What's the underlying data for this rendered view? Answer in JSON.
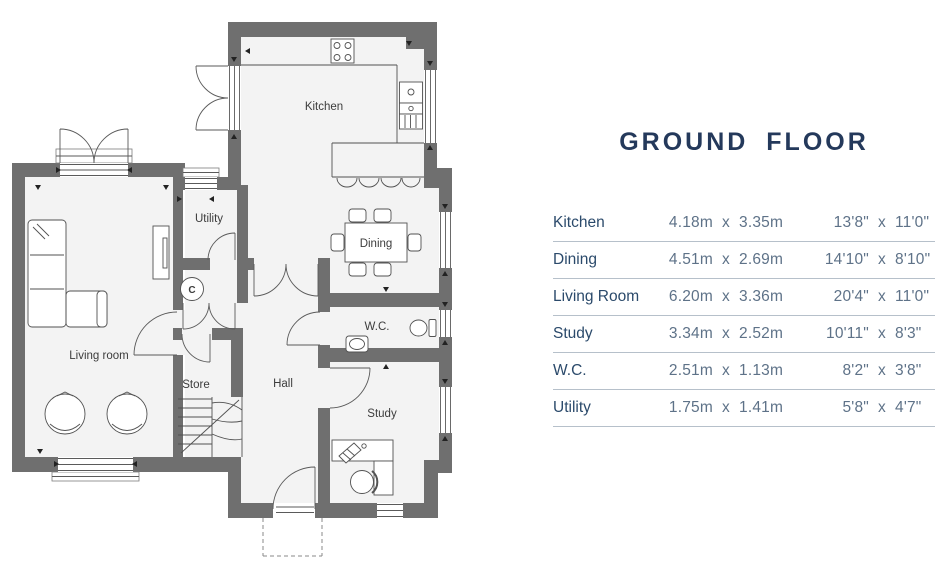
{
  "title": "GROUND FLOOR",
  "plan": {
    "labels": {
      "kitchen": "Kitchen",
      "utility": "Utility",
      "dining": "Dining",
      "living_room": "Living room",
      "wc": "W.C.",
      "store": "Store",
      "hall": "Hall",
      "study": "Study",
      "cylinder": "C"
    }
  },
  "dimensions_table": {
    "separator": "x",
    "rows": [
      {
        "name": "Kitchen",
        "metric_w": "4.18m",
        "metric_d": "3.35m",
        "imperial_w": "13'8\"",
        "imperial_d": "11'0\""
      },
      {
        "name": "Dining",
        "metric_w": "4.51m",
        "metric_d": "2.69m",
        "imperial_w": "14'10\"",
        "imperial_d": "8'10\""
      },
      {
        "name": "Living Room",
        "metric_w": "6.20m",
        "metric_d": "3.36m",
        "imperial_w": "20'4\"",
        "imperial_d": "11'0\""
      },
      {
        "name": "Study",
        "metric_w": "3.34m",
        "metric_d": "2.52m",
        "imperial_w": "10'11\"",
        "imperial_d": "8'3\""
      },
      {
        "name": "W.C.",
        "metric_w": "2.51m",
        "metric_d": "1.13m",
        "imperial_w": "8'2\"",
        "imperial_d": "3'8\""
      },
      {
        "name": "Utility",
        "metric_w": "1.75m",
        "metric_d": "1.41m",
        "imperial_w": "5'8\"",
        "imperial_d": "4'7\""
      }
    ]
  },
  "colors": {
    "title": "#24395b",
    "room_name": "#2b4a6b",
    "dim_value": "#5e7288",
    "wall": "#6f6f6f",
    "floor": "#f3f3f3",
    "divider": "#b6c0ca"
  }
}
